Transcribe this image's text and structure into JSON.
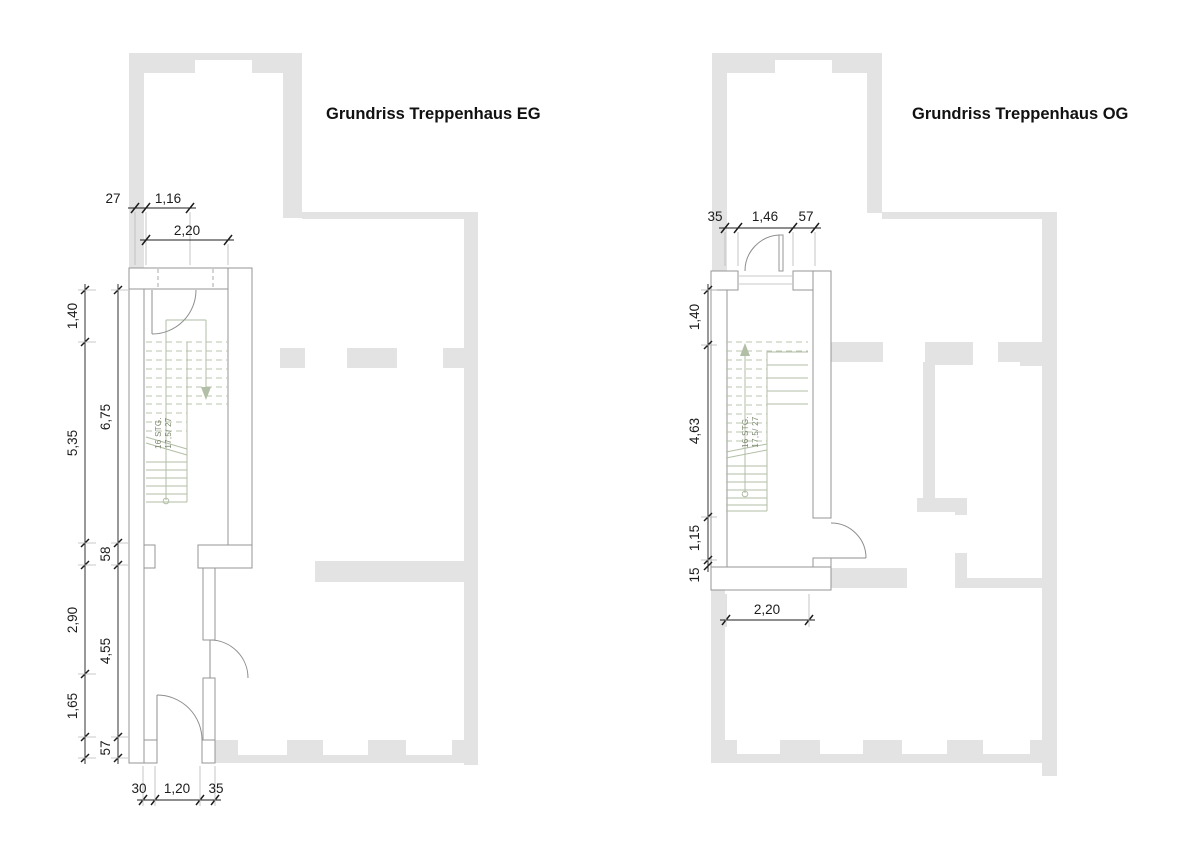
{
  "colors": {
    "existing_wall_gray": "#e3e3e3",
    "new_wall_stroke": "#969696",
    "stair_green": "#b2bfa6",
    "stair_note_color": "#78866b",
    "dimension_color": "#1c1c1c"
  },
  "eg": {
    "title": "Grundriss Treppenhaus EG",
    "stair_note": [
      "16 STG.",
      "17,5/ 27"
    ],
    "dims": {
      "wall_offset": "27",
      "top_opening": "1,16",
      "top_width": "2,20",
      "upper_landing": "1,40",
      "stair_run": "5,35",
      "stair_total": "6,75",
      "mid_wall": "58",
      "corridor": "2,90",
      "corridor_total": "4,55",
      "entry": "1,65",
      "bottom_wall": "57",
      "entry_left_wall": "30",
      "entry_door": "1,20",
      "entry_right_wall": "35"
    }
  },
  "og": {
    "title": "Grundriss Treppenhaus OG",
    "stair_note": [
      "16 STG.",
      "17,5/ 27"
    ],
    "dims": {
      "top_left_wall": "35",
      "top_door": "1,46",
      "top_right_wall": "57",
      "upper_landing": "1,40",
      "stair_run": "4,63",
      "lower_landing": "1,15",
      "bottom_wall": "15",
      "room_width": "2,20"
    }
  }
}
